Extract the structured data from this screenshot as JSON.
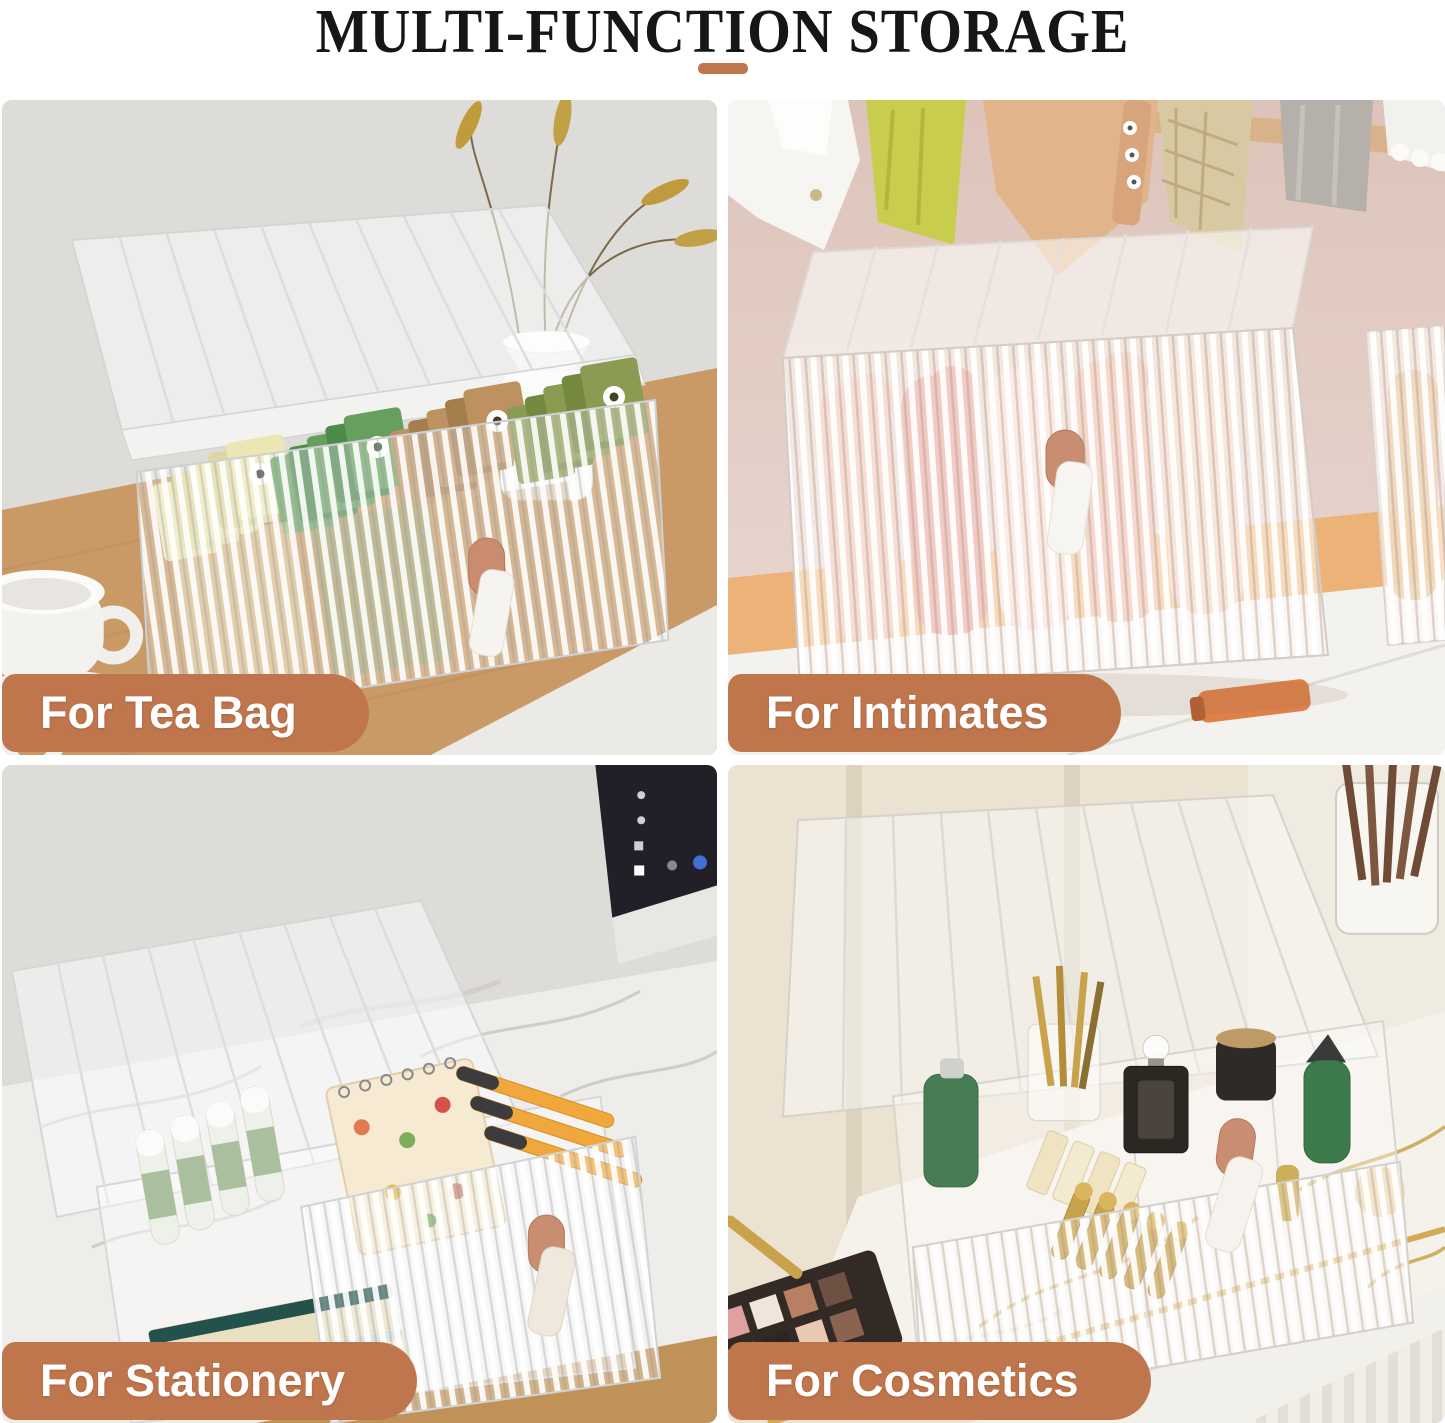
{
  "header": {
    "title": "MULTI-FUNCTION STORAGE"
  },
  "accent": {
    "ribbon_color": "#c0764d",
    "ribbon_text_color": "#ffffff",
    "divider_color": "#c0764d",
    "title_color": "#161616"
  },
  "quadrants": [
    {
      "id": "tea-bag",
      "label": "For Tea Bag"
    },
    {
      "id": "intimates",
      "label": "For Intimates"
    },
    {
      "id": "stationery",
      "label": "For Stationery"
    },
    {
      "id": "cosmetics",
      "label": "For Cosmetics"
    }
  ]
}
